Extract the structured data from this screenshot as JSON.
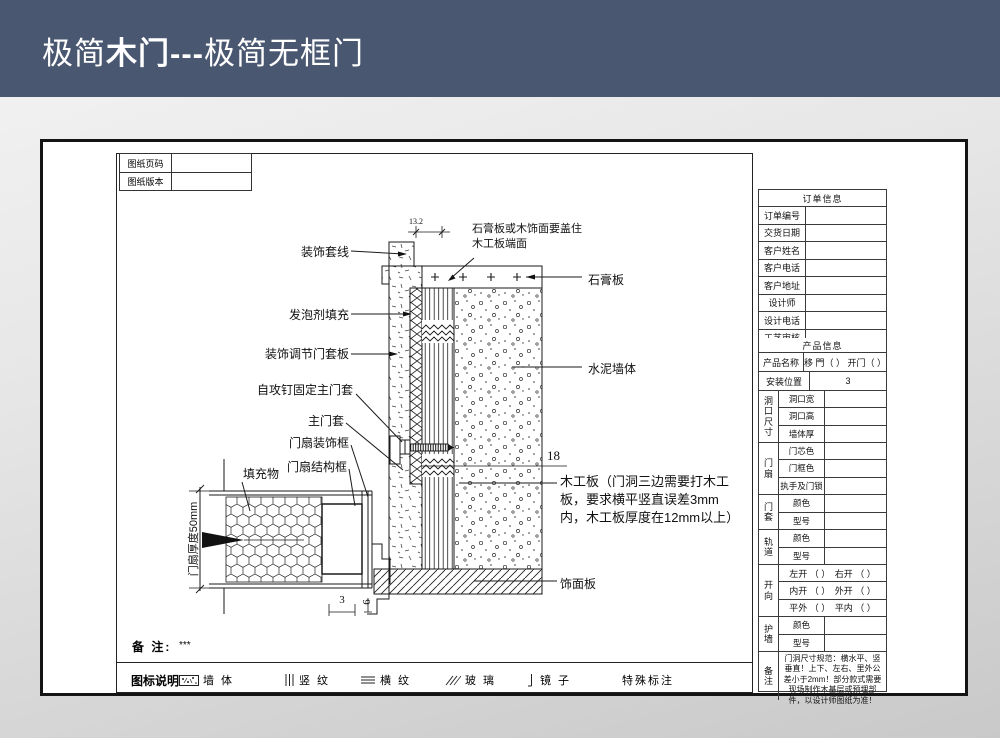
{
  "header": {
    "title_prefix": "极简",
    "title_bold": "木门---",
    "title_suffix": "极简无框门"
  },
  "sheet_meta": {
    "rows": [
      {
        "label": "图纸页码",
        "value": ""
      },
      {
        "label": "图纸版本",
        "value": ""
      }
    ]
  },
  "drawing": {
    "labels_left": [
      "装饰套线",
      "发泡剂填充",
      "装饰调节门套板",
      "自攻钉固定主门套",
      "主门套",
      "门扇装饰框",
      "门扇结构框",
      "填充物"
    ],
    "labels_right": {
      "cover_note": "石膏板或木饰面要盖住木工板端面",
      "gypsum": "石膏板",
      "cement_wall": "水泥墙体",
      "board_note": "木工板（门洞三边需要打木工板，要求横平竖直误差3mm内，木工板厚度在12mm以上）",
      "veneer": "饰面板"
    },
    "dimensions": {
      "top": "13.2",
      "board": "18",
      "gap_a": "3",
      "gap_b": "6",
      "leaf_thickness": "门扇厚度50mm"
    }
  },
  "notes": {
    "label": "备 注:",
    "value": "***"
  },
  "legend": {
    "title": "图标说明:",
    "items": [
      {
        "icon": "wall-hatch-icon",
        "label": "墙 体"
      },
      {
        "icon": "vertical-grain-icon",
        "label": "竖 纹"
      },
      {
        "icon": "horizontal-grain-icon",
        "label": "横 纹"
      },
      {
        "icon": "glass-icon",
        "label": "玻 璃"
      },
      {
        "icon": "mirror-icon",
        "label": "镜 子"
      },
      {
        "icon": "none",
        "label": "特殊标注"
      }
    ]
  },
  "order_info": {
    "title": "订单信息",
    "rows": [
      {
        "label": "订单编号",
        "value": ""
      },
      {
        "label": "交货日期",
        "value": ""
      },
      {
        "label": "客户姓名",
        "value": ""
      },
      {
        "label": "客户电话",
        "value": ""
      },
      {
        "label": "客户地址",
        "value": ""
      },
      {
        "label": "设计师",
        "value": ""
      },
      {
        "label": "设计电话",
        "value": ""
      },
      {
        "label": "工艺审核",
        "value": ""
      }
    ]
  },
  "product_info": {
    "title": "产品信息",
    "name_row": {
      "label": "产品名称",
      "value": "移 門（ ） 开门（ ）"
    },
    "position_row": {
      "label": "安装位置",
      "value": "3"
    },
    "groups": [
      {
        "group": "洞口尺寸",
        "rows": [
          {
            "label": "洞口宽",
            "value": ""
          },
          {
            "label": "洞口高",
            "value": ""
          },
          {
            "label": "墙体厚",
            "value": ""
          }
        ]
      },
      {
        "group": "门扇",
        "rows": [
          {
            "label": "门芯色",
            "value": ""
          },
          {
            "label": "门框色",
            "value": ""
          },
          {
            "label": "执手及门锁",
            "value": ""
          }
        ]
      },
      {
        "group": "门套",
        "rows": [
          {
            "label": "颜色",
            "value": ""
          },
          {
            "label": "型号",
            "value": ""
          }
        ]
      },
      {
        "group": "轨道",
        "rows": [
          {
            "label": "颜色",
            "value": ""
          },
          {
            "label": "型号",
            "value": ""
          }
        ]
      },
      {
        "group": "开向",
        "full_rows": [
          "左开 （ ）　右开 （ ）",
          "内开 （ ）　外开 （ ）",
          "平外 （ ）　平内 （ ）"
        ]
      },
      {
        "group": "护墙",
        "rows": [
          {
            "label": "颜色",
            "value": ""
          },
          {
            "label": "型号",
            "value": ""
          }
        ]
      },
      {
        "group": "备注",
        "note": "门洞尺寸规范：横水平、竖垂直！上下、左右、里外公差小于2mm！部分款式需要现场制作木基层或预埋部件，以设计师图纸为准！"
      }
    ]
  },
  "colors": {
    "header_bg": "#4a5770",
    "line": "#1a1a1a"
  }
}
